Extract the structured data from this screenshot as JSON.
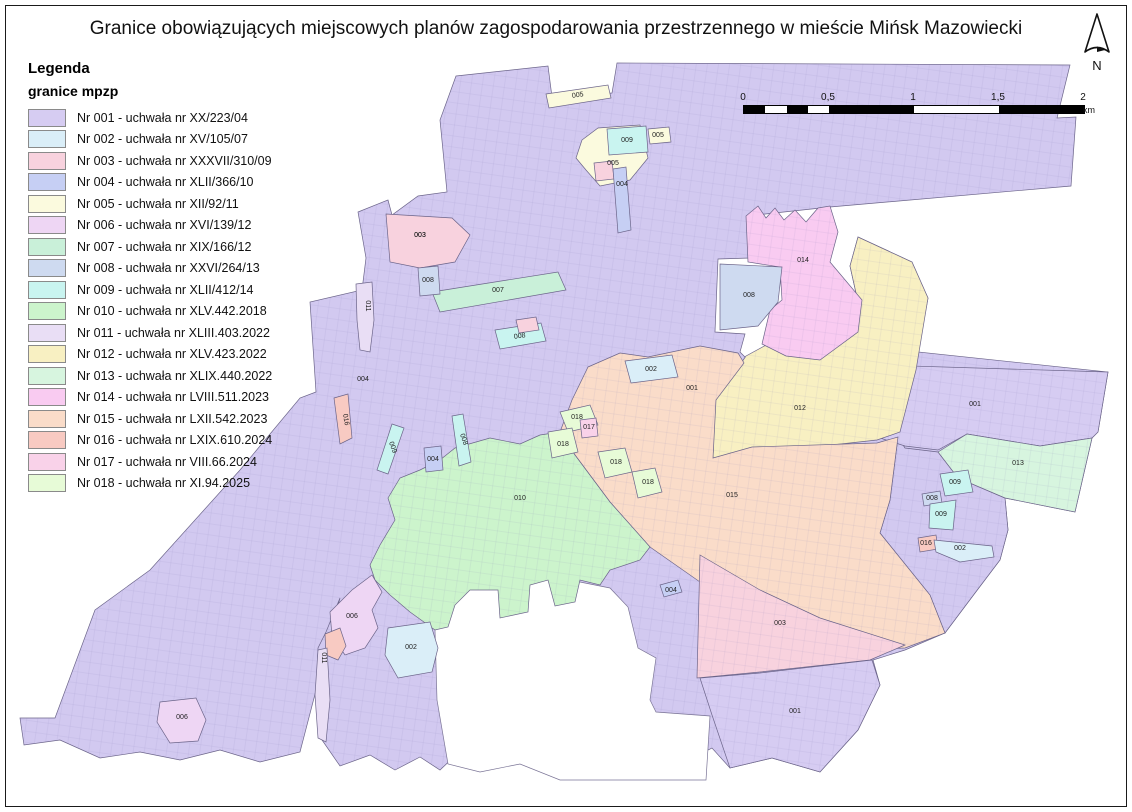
{
  "title": "Granice obowiązujących miejscowych planów zagospodarowania przestrzennego w mieście Mińsk Mazowiecki",
  "north": {
    "label": "N"
  },
  "scale_bar": {
    "tick_labels": [
      "0",
      "0,5",
      "1",
      "1,5",
      "2"
    ],
    "unit": "km",
    "segments": [
      [
        0,
        0.0625,
        "#000"
      ],
      [
        0.0625,
        0.125,
        "#fff"
      ],
      [
        0.125,
        0.1875,
        "#000"
      ],
      [
        0.1875,
        0.25,
        "#fff"
      ],
      [
        0.25,
        0.5,
        "#000"
      ],
      [
        0.5,
        0.75,
        "#fff"
      ],
      [
        0.75,
        1,
        "#000"
      ]
    ]
  },
  "legend": {
    "heading": "Legenda",
    "subheading": "granice mpzp",
    "items": [
      {
        "id": "001",
        "label": "Nr 001 - uchwała nr XX/223/04",
        "color": "#d6ccf2"
      },
      {
        "id": "002",
        "label": "Nr 002 - uchwała nr XV/105/07",
        "color": "#daeef8"
      },
      {
        "id": "003",
        "label": "Nr 003 - uchwała nr XXXVII/310/09",
        "color": "#f8d2de"
      },
      {
        "id": "004",
        "label": "Nr 004 - uchwała nr XLII/366/10",
        "color": "#c6cff4"
      },
      {
        "id": "005",
        "label": "Nr 005 - uchwała nr XII/92/11",
        "color": "#fbfade"
      },
      {
        "id": "006",
        "label": "Nr 006 - uchwała nr XVI/139/12",
        "color": "#eed6f4"
      },
      {
        "id": "007",
        "label": "Nr 007 - uchwała nr XIX/166/12",
        "color": "#c9f0d9"
      },
      {
        "id": "008",
        "label": "Nr 008 - uchwała nr XXVI/264/13",
        "color": "#cedaf0"
      },
      {
        "id": "009",
        "label": "Nr 009 - uchwała nr XLII/412/14",
        "color": "#c9f4f0"
      },
      {
        "id": "010",
        "label": "Nr 010 - uchwała nr XLV.442.2018",
        "color": "#ccf4cc"
      },
      {
        "id": "011",
        "label": "Nr 011 - uchwała nr XLIII.403.2022",
        "color": "#e9def5"
      },
      {
        "id": "012",
        "label": "Nr 012 - uchwała nr XLV.423.2022",
        "color": "#f8f0c2"
      },
      {
        "id": "013",
        "label": "Nr 013 - uchwała nr XLIX.440.2022",
        "color": "#d7f5df"
      },
      {
        "id": "014",
        "label": "Nr 014 - uchwała nr LVIII.511.2023",
        "color": "#f9cbf1"
      },
      {
        "id": "015",
        "label": "Nr 015 - uchwała nr LXII.542.2023",
        "color": "#fadcc9"
      },
      {
        "id": "016",
        "label": "Nr 016 - uchwała nr LXIX.610.2024",
        "color": "#f8cac2"
      },
      {
        "id": "017",
        "label": "Nr 017 - uchwała nr VIII.66.2024",
        "color": "#f9d2e9"
      },
      {
        "id": "018",
        "label": "Nr 018 - uchwała nr XI.94.2025",
        "color": "#e7fbd7"
      }
    ]
  },
  "map": {
    "regions": [
      {
        "id": "001-main",
        "color": "#d2c9f0",
        "textured": true,
        "points": "456,76 548,66 552,97 612,93 617,63 1070,65 1057,118 1076,117 1071,186 830,207 747,216 750,258 718,259 715,332 745,334 740,352 746,358 768,344 796,330 826,263 858,302 850,266 858,237 912,262 928,298 918,352 1108,372 1098,432 1092,438 1075,512 1005,498 1008,530 1000,560 975,593 945,633 905,650 873,660 880,685 858,730 820,772 772,758 730,768 712,748 680,764 650,775 620,757 590,772 560,753 530,768 505,753 480,766 458,753 440,770 420,757 395,770 370,755 340,766 322,740 316,700 318,648 326,632 340,598 300,752 260,762 220,750 180,760 140,752 100,758 60,740 24,745 20,718 55,718 95,610 150,570 240,470 300,398 316,392 310,302 362,290 366,258 358,212 388,200 392,215 418,196 447,192 440,120"
      },
      {
        "id": "white-bay",
        "color": "#ffffff",
        "points": "435,630 460,592 480,570 505,562 525,556 545,556 560,578 610,588 628,607 638,648 656,658 650,700 656,712 710,716 706,780 560,780 520,764 480,772 448,764 437,700"
      },
      {
        "id": "se-001",
        "color": "#d2c9f0",
        "textured": true,
        "points": "898,437 905,448 938,452 958,478 1005,498 1008,530 1000,560 975,593 945,633 930,595 880,533 890,500"
      },
      {
        "id": "001-right",
        "color": "#d6ccf2",
        "textured": true,
        "label": "001",
        "lx": 975,
        "ly": 406,
        "points": "878,365 1108,372 1098,432 1092,438 1040,446 967,434 938,450 905,446 880,438"
      },
      {
        "id": "013",
        "color": "#d7f5df",
        "textured": true,
        "label": "013",
        "lx": 1018,
        "ly": 465,
        "points": "938,452 967,434 1040,446 1092,438 1075,512 1005,498 958,478"
      },
      {
        "id": "012",
        "color": "#f8f0c2",
        "textured": true,
        "label": "012",
        "lx": 800,
        "ly": 410,
        "points": "746,356 715,400 713,458 877,440 900,432 916,370 928,298 912,262 858,237 850,266 858,302 826,263 796,330 768,344"
      },
      {
        "id": "014",
        "color": "#f9cbf1",
        "textured": true,
        "label": "014",
        "lx": 803,
        "ly": 262,
        "points": "746,216 758,206 766,218 775,208 784,220 795,210 806,222 818,208 830,206 838,232 830,262 862,300 858,332 820,360 786,356 762,344 770,310 782,300 780,267 748,262"
      },
      {
        "id": "008-block",
        "color": "#cedaf0",
        "label": "008",
        "lx": 749,
        "ly": 297,
        "points": "720,264 782,267 778,302 758,326 720,330"
      },
      {
        "id": "015",
        "color": "#fadcc9",
        "textured": true,
        "label": "015",
        "lx": 732,
        "ly": 497,
        "points": "588,367 620,353 648,357 700,346 738,353 744,363 716,400 713,458 752,447 877,443 898,437 890,500 880,533 930,595 945,633 905,648 860,650 810,627 760,610 700,582 650,547 610,502 575,455 560,432 572,400"
      },
      {
        "id": "010",
        "color": "#ccf4cc",
        "textured": true,
        "label": "010",
        "lx": 520,
        "ly": 500,
        "points": "455,448 490,438 520,444 540,435 560,432 575,455 610,502 650,547 640,560 610,570 600,585 580,580 575,602 555,606 548,580 530,585 528,612 500,618 498,590 470,590 455,605 448,627 435,630 410,612 390,595 375,580 370,565 380,545 395,520 388,498 400,478 420,470 440,460"
      },
      {
        "id": "003-top",
        "color": "#f8d2de",
        "label": "003",
        "lx": 420,
        "ly": 237,
        "points": "386,214 452,218 470,235 455,262 420,268 390,262"
      },
      {
        "id": "003-bottom",
        "color": "#f8d2de",
        "textured": true,
        "label": "003",
        "lx": 780,
        "ly": 625,
        "points": "700,555 760,590 820,618 905,645 870,660 760,672 697,678"
      },
      {
        "id": "001-lobe",
        "color": "#d6ccf2",
        "textured": true,
        "label": "001",
        "lx": 795,
        "ly": 713,
        "points": "700,678 760,673 872,660 880,685 858,730 820,772 772,758 730,768 712,715"
      },
      {
        "id": "006-west",
        "color": "#eed6f4",
        "label": "006",
        "lx": 352,
        "ly": 618,
        "points": "330,612 352,590 372,575 382,592 372,610 378,628 365,648 345,655 332,636"
      },
      {
        "id": "016-patch",
        "color": "#f8cac2",
        "points": "325,634 340,628 346,646 338,660 326,655"
      },
      {
        "id": "002-south",
        "color": "#daeef8",
        "label": "002",
        "lx": 411,
        "ly": 649,
        "points": "388,628 430,622 438,648 432,672 398,678 385,655"
      },
      {
        "id": "011-strip-s",
        "color": "#e9def5",
        "points": "318,650 327,648 330,700 326,742 318,738 315,695"
      },
      {
        "id": "011-strip-n",
        "color": "#e9def5",
        "points": "356,284 372,282 374,320 370,352 360,350 357,320"
      },
      {
        "id": "016-strip-w",
        "color": "#f8cac2",
        "points": "334,398 348,394 352,438 340,444"
      },
      {
        "id": "007-strip",
        "color": "#c9f0d9",
        "label": "007",
        "lx": 498,
        "ly": 292,
        "points": "432,292 558,272 566,290 440,312"
      },
      {
        "id": "008-box-n",
        "color": "#cedaf0",
        "label": "008",
        "lx": 428,
        "ly": 282,
        "points": "418,268 438,266 440,294 420,296"
      },
      {
        "id": "009-strip-a",
        "color": "#c9f4f0",
        "points": "392,424 404,428 388,474 377,470"
      },
      {
        "id": "008-strip-b",
        "color": "#c9f4f0",
        "points": "452,416 463,414 471,462 459,466"
      },
      {
        "id": "004-small",
        "color": "#c6cff4",
        "label": "004",
        "lx": 433,
        "ly": 461,
        "points": "424,448 441,446 443,470 426,472"
      },
      {
        "id": "008-strip-c",
        "color": "#c9f4f0",
        "points": "495,330 541,323 546,341 500,349"
      },
      {
        "id": "003-sm-c",
        "color": "#f8d2de",
        "points": "516,320 536,317 539,330 519,333"
      },
      {
        "id": "002-rect",
        "color": "#daeef8",
        "label": "002",
        "lx": 651,
        "ly": 371,
        "points": "625,361 672,355 678,377 631,383"
      },
      {
        "id": "005-strip-top",
        "color": "#fbfade",
        "points": "546,94 608,85 611,98 549,108"
      },
      {
        "id": "005-blob",
        "color": "#fbfade",
        "label": "005",
        "lx": 613,
        "ly": 165,
        "points": "582,140 598,128 640,125 648,158 630,180 600,186 586,170 576,158"
      },
      {
        "id": "009-box",
        "color": "#c9f4f0",
        "label": "009",
        "lx": 627,
        "ly": 142,
        "points": "607,129 646,126 648,152 609,155"
      },
      {
        "id": "005-sm",
        "color": "#fbfade",
        "label": "005",
        "lx": 658,
        "ly": 137,
        "points": "648,129 669,127 671,142 650,144"
      },
      {
        "id": "003-sm-n",
        "color": "#f8d2de",
        "points": "594,163 612,161 614,179 596,181"
      },
      {
        "id": "004-strip-n",
        "color": "#c6cff4",
        "label": "004",
        "lx": 622,
        "ly": 186,
        "points": "613,169 626,167 631,230 618,233"
      },
      {
        "id": "018-p1",
        "color": "#e7fbd7",
        "label": "018",
        "lx": 577,
        "ly": 419,
        "points": "560,412 590,405 598,425 568,432"
      },
      {
        "id": "018-p2",
        "color": "#e7fbd7",
        "label": "018",
        "lx": 563,
        "ly": 446,
        "points": "548,432 572,428 578,452 552,458"
      },
      {
        "id": "018-p3",
        "color": "#e7fbd7",
        "label": "018",
        "lx": 616,
        "ly": 464,
        "points": "598,452 625,448 632,472 605,478"
      },
      {
        "id": "018-p4",
        "color": "#e7fbd7",
        "label": "018",
        "lx": 648,
        "ly": 484,
        "points": "632,472 655,468 662,492 638,498"
      },
      {
        "id": "017-sm",
        "color": "#f9d2e9",
        "label": "017",
        "lx": 589,
        "ly": 429,
        "points": "580,420 596,418 598,436 582,438"
      },
      {
        "id": "009-blob-a",
        "color": "#c9f4f0",
        "label": "009",
        "lx": 955,
        "ly": 484,
        "points": "940,474 968,470 973,492 945,496"
      },
      {
        "id": "008-tiny-se",
        "color": "#cedaf0",
        "label": "008",
        "lx": 932,
        "ly": 500,
        "points": "922,494 940,491 942,503 924,506"
      },
      {
        "id": "009-blob-b",
        "color": "#c9f4f0",
        "label": "009",
        "lx": 941,
        "ly": 516,
        "points": "930,504 956,500 953,530 929,528"
      },
      {
        "id": "016-tiny-se",
        "color": "#f8cac2",
        "label": "016",
        "lx": 926,
        "ly": 545,
        "points": "918,538 936,535 938,549 920,552"
      },
      {
        "id": "002-strip-se",
        "color": "#daeef8",
        "label": "002",
        "lx": 960,
        "ly": 550,
        "points": "934,540 992,546 994,557 960,562 936,552"
      },
      {
        "id": "006-sw",
        "color": "#eed6f4",
        "label": "006",
        "lx": 182,
        "ly": 719,
        "points": "160,702 196,698 206,720 198,741 170,743 157,722"
      },
      {
        "id": "004-tiny-c",
        "color": "#c6cff4",
        "label": "004",
        "lx": 671,
        "ly": 592,
        "points": "660,585 678,580 682,592 664,597"
      }
    ],
    "labels": [
      {
        "text": "005",
        "x": 578,
        "y": 97,
        "rot": -8
      },
      {
        "text": "003",
        "x": 420,
        "y": 237,
        "rot": 0
      },
      {
        "text": "011",
        "x": 366,
        "y": 306,
        "rot": 90
      },
      {
        "text": "004",
        "x": 363,
        "y": 381,
        "rot": 0
      },
      {
        "text": "016",
        "x": 344,
        "y": 420,
        "rot": 80
      },
      {
        "text": "009",
        "x": 391,
        "y": 448,
        "rot": 70
      },
      {
        "text": "008",
        "x": 462,
        "y": 440,
        "rot": 70
      },
      {
        "text": "008",
        "x": 520,
        "y": 338,
        "rot": -9
      },
      {
        "text": "001",
        "x": 692,
        "y": 390,
        "rot": 0
      },
      {
        "text": "011",
        "x": 322,
        "y": 658,
        "rot": 90
      }
    ]
  }
}
